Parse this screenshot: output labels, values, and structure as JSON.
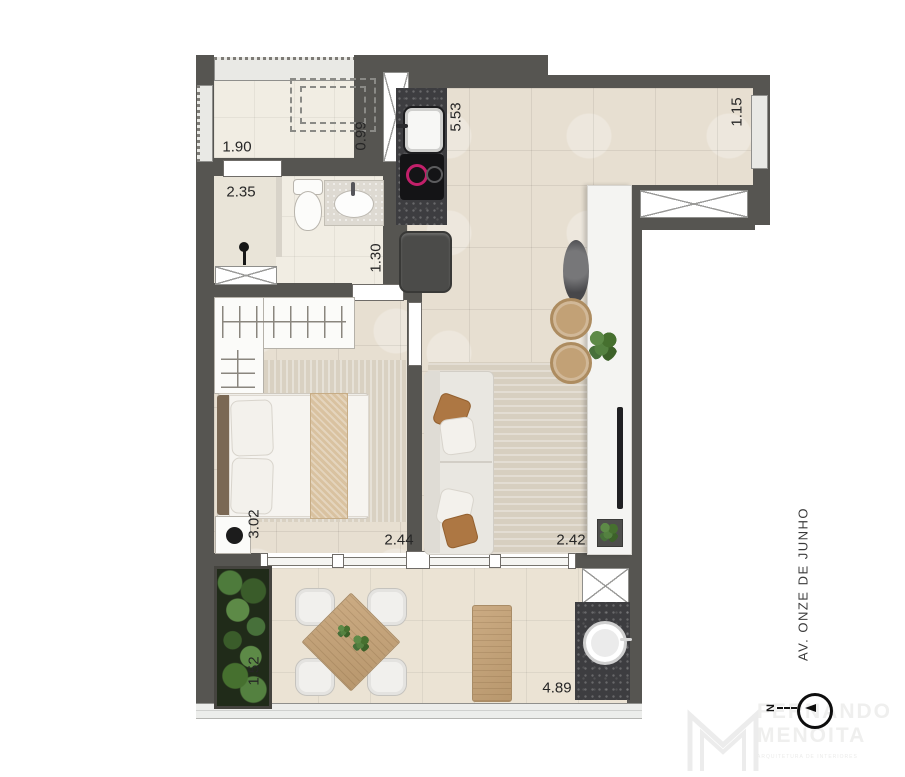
{
  "dimensions": {
    "laundry_width": "1.90",
    "laundry_depth": "0.99",
    "bathroom_width": "2.35",
    "bathroom_depth": "1.30",
    "kitchen_run": "5.53",
    "side_window": "1.15",
    "bedroom_depth": "3.02",
    "bedroom_width": "2.44",
    "living_width": "2.42",
    "terrace_depth": "1.52",
    "terrace_width": "4.89"
  },
  "street": {
    "label": "AV. ONZE DE JUNHO"
  },
  "compass": {
    "north": "N"
  },
  "brand": {
    "line1": "FERNANDO",
    "line2": "MENOITA",
    "tagline": "ARQUITETURA DE INTERIORES"
  },
  "colors": {
    "wall": "#565551",
    "floor_tile": "#e7dfd1",
    "wet_room_floor": "#f1ede3",
    "terrace_floor": "#ebe3d4",
    "granite": "#3d3d40",
    "burner_accent": "#c2206a",
    "wood": "#c4a47c",
    "foliage": "#4e7b3c",
    "island_white": "#f4f4f2"
  }
}
